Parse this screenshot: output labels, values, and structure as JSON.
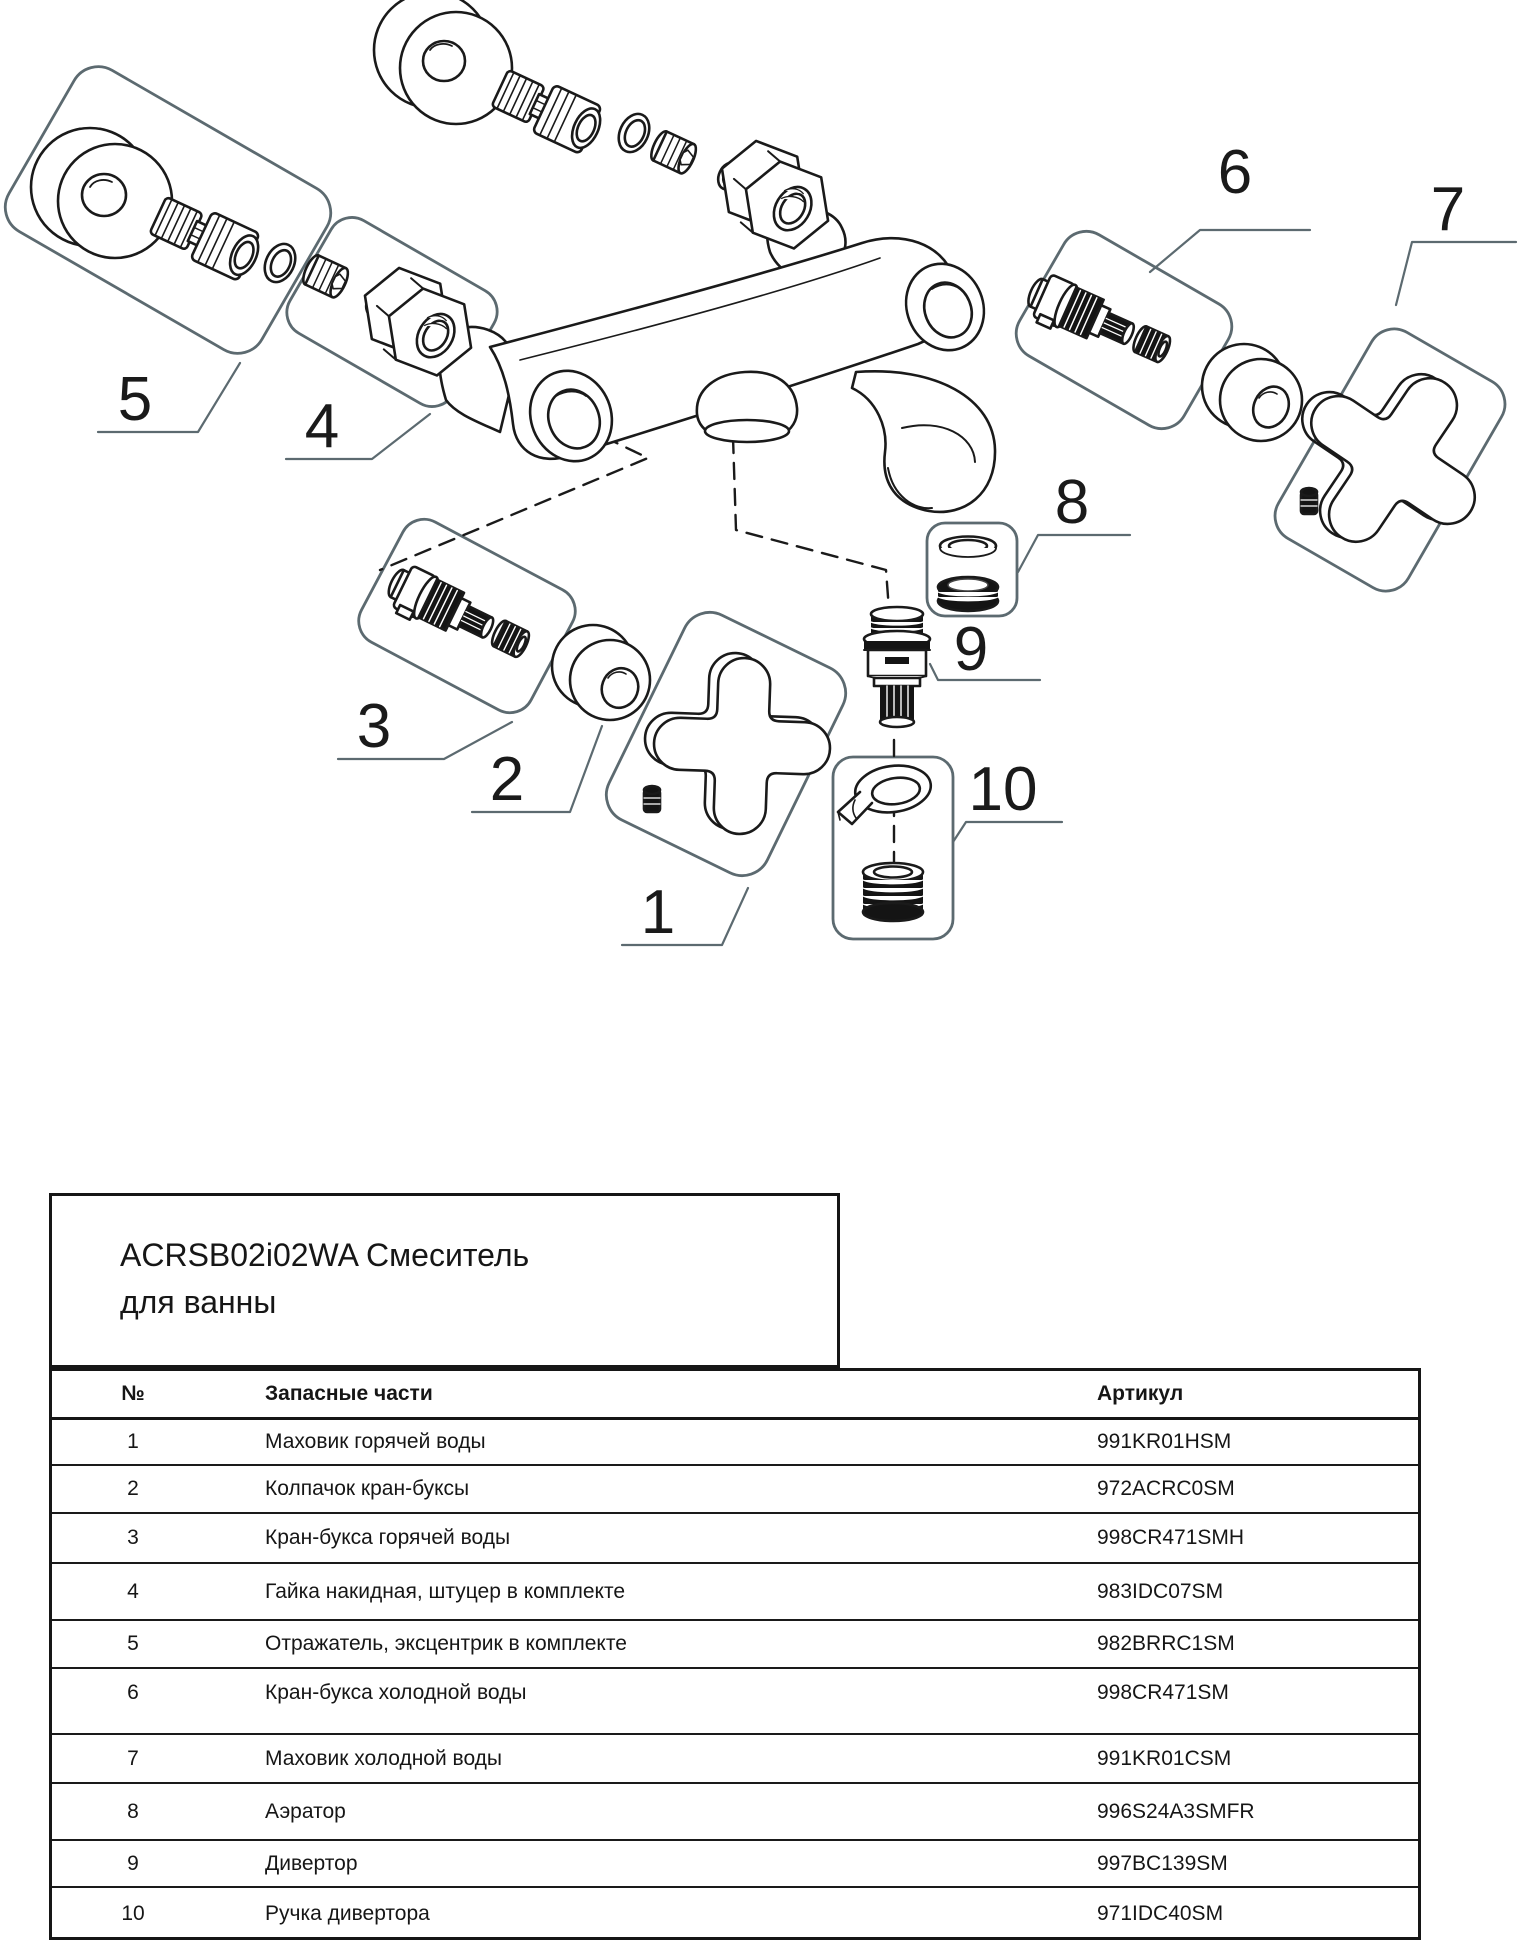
{
  "title": {
    "line1": "ACRSB02i02WA Смеситель",
    "line2": "для ванны"
  },
  "table": {
    "headers": {
      "num": "№",
      "parts": "Запасные части",
      "sku": "Артикул"
    },
    "rows": [
      {
        "num": "1",
        "part": "Маховик горячей воды",
        "sku": "991KR01HSM"
      },
      {
        "num": "2",
        "part": "Колпачок кран-буксы",
        "sku": "972ACRC0SM"
      },
      {
        "num": "3",
        "part": "Кран-букса горячей воды",
        "sku": "998CR471SMH"
      },
      {
        "num": "4",
        "part": "Гайка накидная, штуцер в комплекте",
        "sku": "983IDC07SM"
      },
      {
        "num": "5",
        "part": "Отражатель, эксцентрик в комплекте",
        "sku": "982BRRC1SM"
      },
      {
        "num": "6",
        "part": "Кран-букса холодной воды",
        "sku": "998CR471SM"
      },
      {
        "num": "7",
        "part": "Маховик холодной воды",
        "sku": "991KR01CSM"
      },
      {
        "num": "8",
        "part": "Аэратор",
        "sku": "996S24A3SMFR"
      },
      {
        "num": "9",
        "part": "Дивертор",
        "sku": "997BC139SM"
      },
      {
        "num": "10",
        "part": "Ручка дивертора",
        "sku": "971IDC40SM"
      }
    ]
  },
  "diagram": {
    "callouts": [
      {
        "label": "1"
      },
      {
        "label": "2"
      },
      {
        "label": "3"
      },
      {
        "label": "4"
      },
      {
        "label": "5"
      },
      {
        "label": "6"
      },
      {
        "label": "7"
      },
      {
        "label": "8"
      },
      {
        "label": "9"
      },
      {
        "label": "10"
      }
    ],
    "colors": {
      "line": "#1a1a1a",
      "group_box": "#5c6a70",
      "dark_fill": "#141414"
    }
  }
}
